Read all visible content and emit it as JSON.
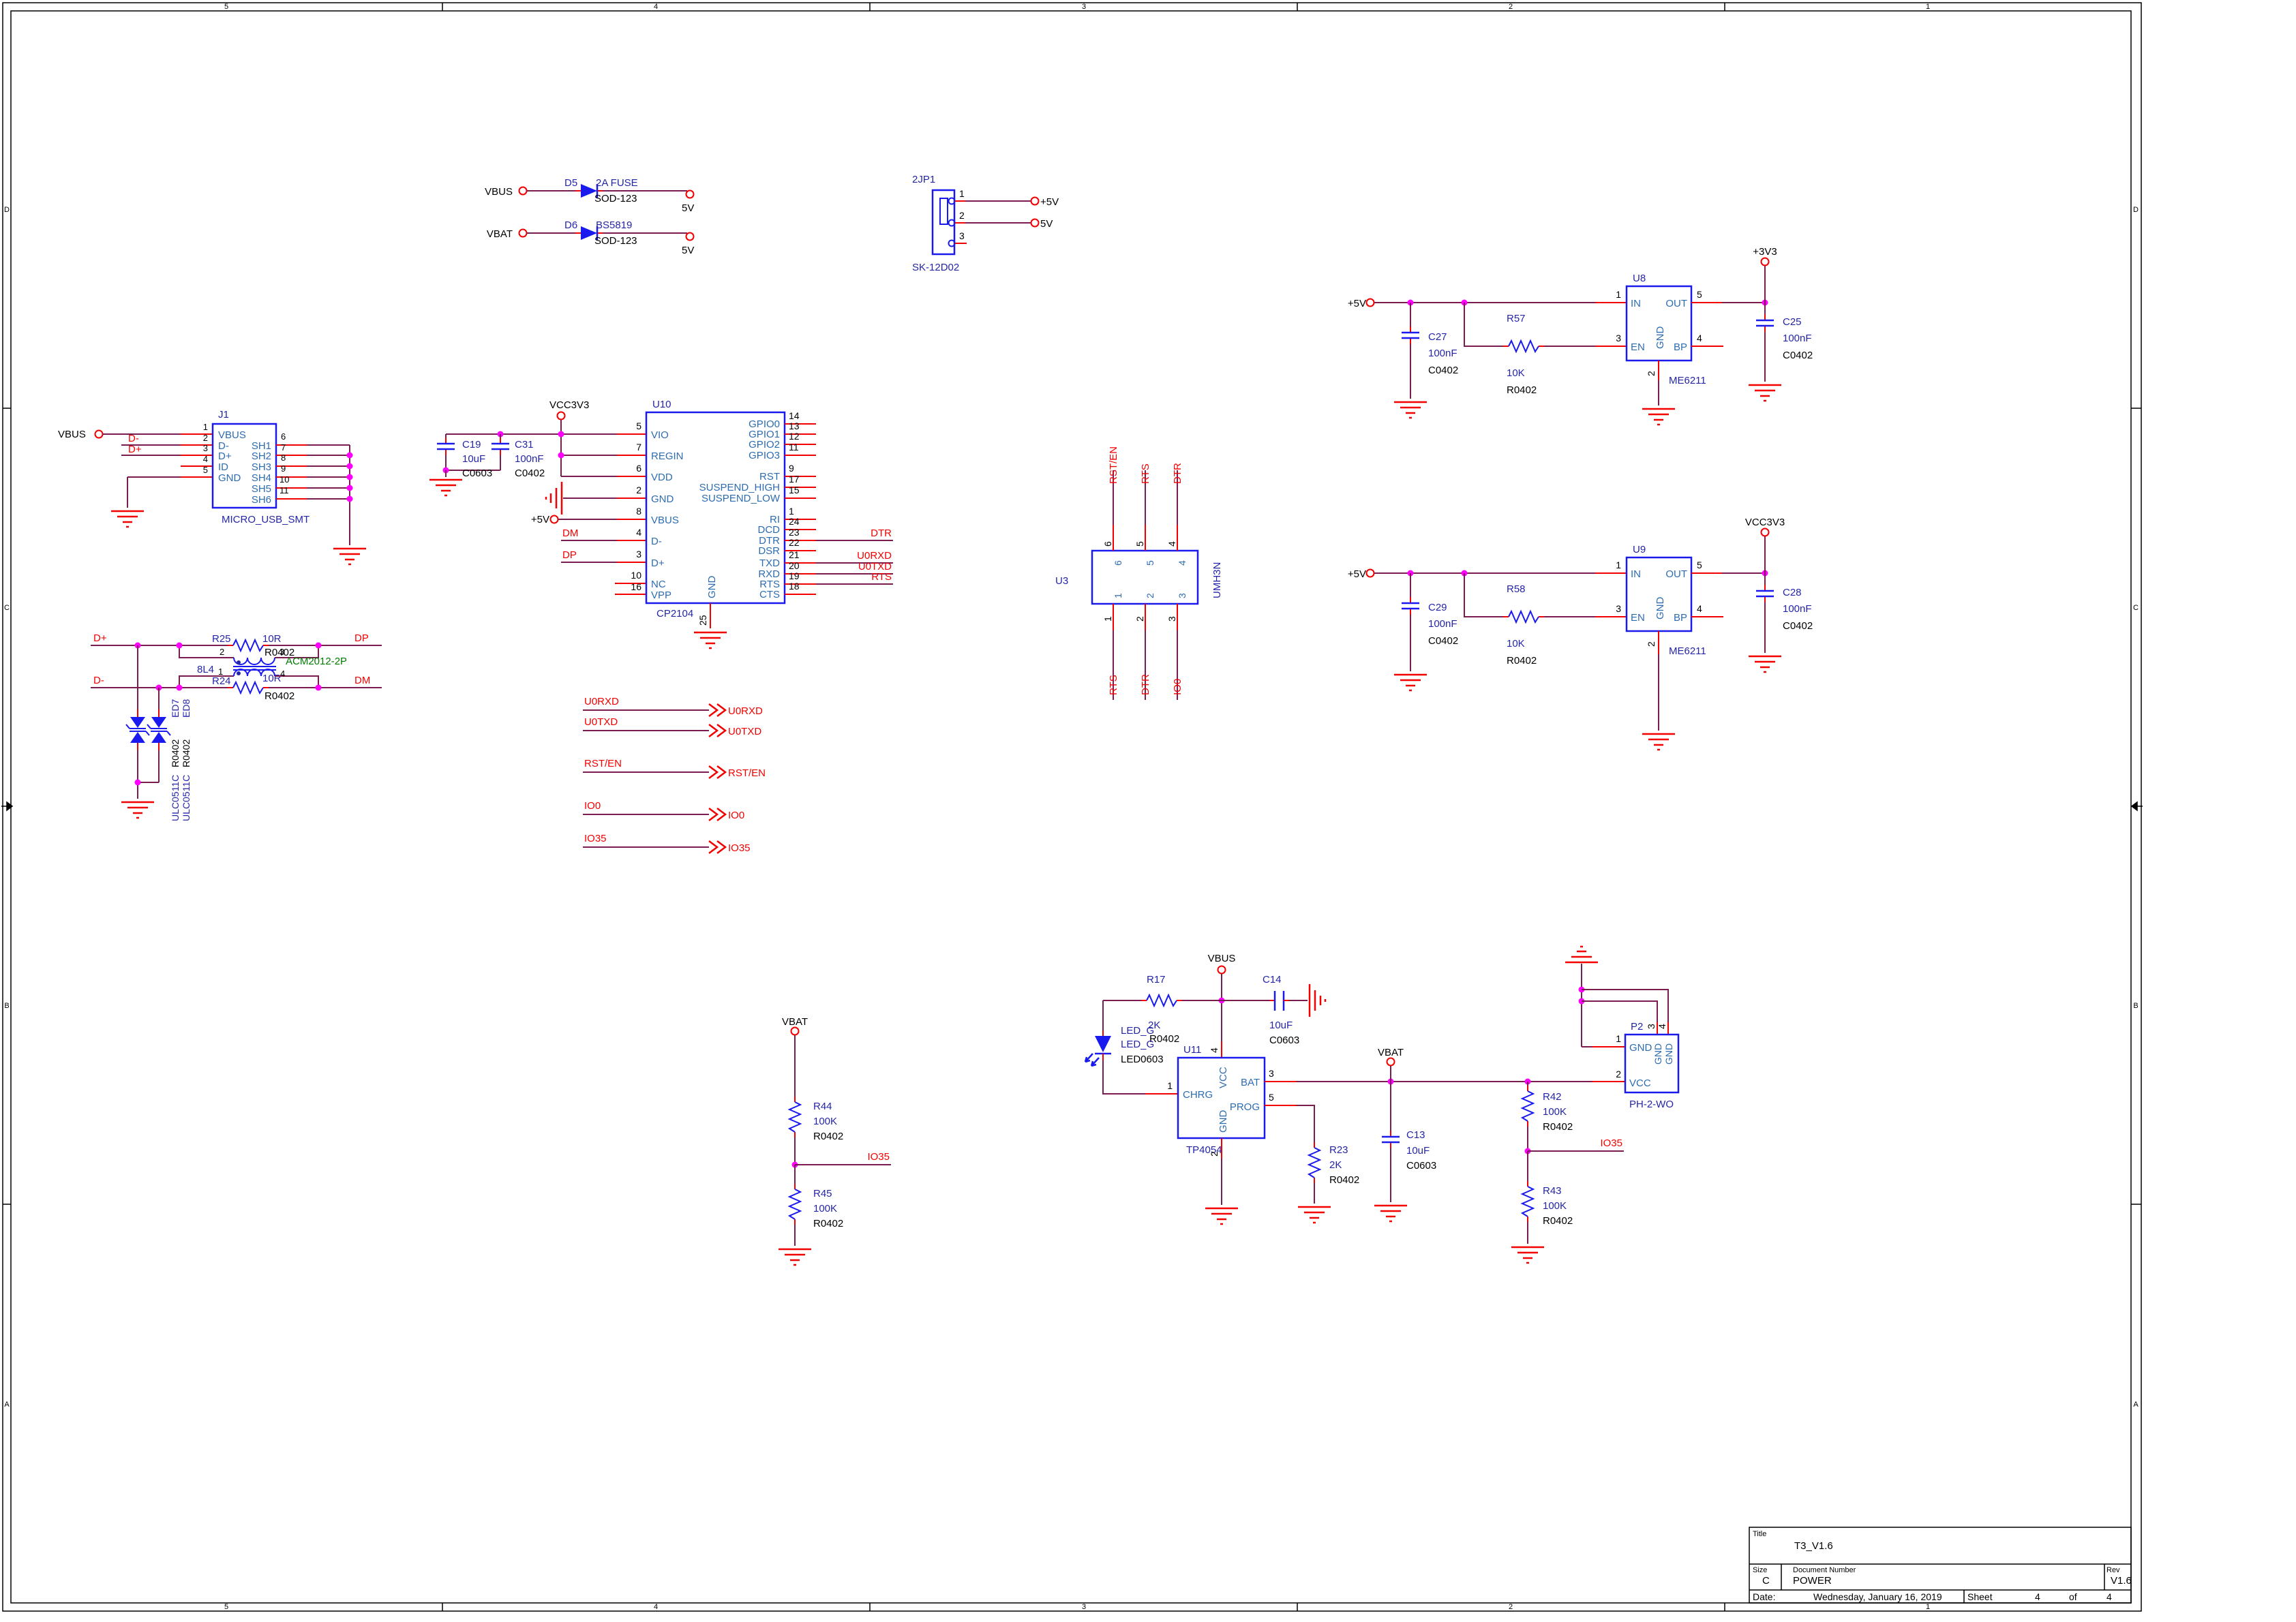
{
  "frame": {
    "zones_h": [
      "5",
      "4",
      "3",
      "2",
      "1"
    ],
    "zones_v": [
      "D",
      "C",
      "B",
      "A"
    ],
    "tb": {
      "title_label": "Title",
      "title": "T3_V1.6",
      "size_label": "Size",
      "size": "C",
      "doc_label": "Document Number",
      "doc": "POWER",
      "rev_label": "Rev",
      "rev": "V1.6",
      "date_label": "Date:",
      "date": "Wednesday, January 16, 2019",
      "sheet_label": "Sheet",
      "sheet_no": "4",
      "of": "of",
      "sheet_total": "4"
    }
  },
  "power_in": {
    "vbus_label": "VBUS",
    "vbat_label": "VBAT",
    "d5_ref": "D5",
    "d5_val": "2A FUSE",
    "d5_fp": "SOD-123",
    "d5_net": "5V",
    "d6_ref": "D6",
    "d6_val": "BS5819",
    "d6_fp": "SOD-123",
    "d6_net": "5V"
  },
  "jp1": {
    "ref": "2JP1",
    "fp": "SK-12D02",
    "p1": "1",
    "p2": "2",
    "p3": "3",
    "net1": "+5V",
    "net2": "5V"
  },
  "usb": {
    "ref": "J1",
    "fp": "MICRO_USB_SMT",
    "vbus": "VBUS",
    "pin_numbers": [
      "1",
      "2",
      "3",
      "4",
      "5",
      "6",
      "7",
      "8",
      "9",
      "10",
      "11"
    ],
    "left_names": [
      "VBUS",
      "D-",
      "D+",
      "ID",
      "GND"
    ],
    "right_names": [
      "SH1",
      "SH2",
      "SH3",
      "SH4",
      "SH5",
      "SH6"
    ],
    "dm_label": "D-",
    "dp_label": "D+"
  },
  "esd": {
    "dplus": "D+",
    "dminus": "D-",
    "dp": "DP",
    "dm": "DM",
    "r25_ref": "R25",
    "r25_val": "10R",
    "r25_fp": "R0402",
    "r24_ref": "R24",
    "r24_val": "10R",
    "r24_fp": "R0402",
    "choke_ref": "8L4",
    "choke_val": "ACM2012-2P",
    "choke_pins": [
      "1",
      "2",
      "3",
      "4"
    ],
    "ed7": "ED7",
    "ed8": "ED8",
    "ed_fp1": "R0402",
    "ed_fp2": "R0402",
    "ed_val1": "ULC0511C",
    "ed_val2": "ULC0511C"
  },
  "cp2104": {
    "ref": "U10",
    "val": "CP2104",
    "vcc": "VCC3V3",
    "p5v": "+5V",
    "c19_ref": "C19",
    "c19_val": "10uF",
    "c19_fp": "C0603",
    "c31_ref": "C31",
    "c31_val": "100nF",
    "c31_fp": "C0402",
    "dm": "DM",
    "dp": "DP",
    "left": [
      {
        "num": "5",
        "name": "VIO"
      },
      {
        "num": "7",
        "name": "REGIN"
      },
      {
        "num": "6",
        "name": "VDD"
      },
      {
        "num": "2",
        "name": "GND"
      },
      {
        "num": "8",
        "name": "VBUS"
      },
      {
        "num": "4",
        "name": "D-"
      },
      {
        "num": "3",
        "name": "D+"
      },
      {
        "num": "10",
        "name": "NC"
      },
      {
        "num": "16",
        "name": "VPP"
      }
    ],
    "right": [
      {
        "num": "14",
        "name": "GPIO0"
      },
      {
        "num": "13",
        "name": "GPIO1"
      },
      {
        "num": "12",
        "name": "GPIO2"
      },
      {
        "num": "11",
        "name": "GPIO3"
      },
      {
        "num": "9",
        "name": "RST"
      },
      {
        "num": "17",
        "name": "SUSPEND_HIGH"
      },
      {
        "num": "15",
        "name": "SUSPEND_LOW"
      },
      {
        "num": "1",
        "name": "RI"
      },
      {
        "num": "24",
        "name": "DCD"
      },
      {
        "num": "23",
        "name": "DTR"
      },
      {
        "num": "22",
        "name": "DSR"
      },
      {
        "num": "21",
        "name": "TXD"
      },
      {
        "num": "20",
        "name": "RXD"
      },
      {
        "num": "19",
        "name": "RTS"
      },
      {
        "num": "18",
        "name": "CTS"
      }
    ],
    "gnd_pin": {
      "num": "25",
      "name": "GND"
    },
    "net_dtr": "DTR",
    "net_u0rxd": "U0RXD",
    "net_u0txd": "U0TXD",
    "net_rts": "RTS"
  },
  "u3": {
    "ref": "U3",
    "val": "UMH3N",
    "top": [
      {
        "num": "6",
        "net": "RST/EN"
      },
      {
        "num": "5",
        "net": "RTS"
      },
      {
        "num": "4",
        "net": "DTR"
      }
    ],
    "bottom": [
      {
        "num": "1",
        "net": "RTS"
      },
      {
        "num": "2",
        "net": "DTR"
      },
      {
        "num": "3",
        "net": "IO0"
      }
    ]
  },
  "offpage": [
    {
      "net": "U0RXD"
    },
    {
      "net": "U0TXD"
    },
    {
      "net": "RST/EN"
    },
    {
      "net": "IO0"
    },
    {
      "net": "IO35"
    }
  ],
  "ldo1": {
    "in_net": "+5V",
    "ref": "U8",
    "val": "ME6211",
    "out_net": "+3V3",
    "c_in_ref": "C27",
    "c_in_val": "100nF",
    "c_in_fp": "C0402",
    "r_ref": "R57",
    "r_val": "10K",
    "r_fp": "R0402",
    "c_out_ref": "C25",
    "c_out_val": "100nF",
    "c_out_fp": "C0402",
    "pins": {
      "in": {
        "num": "1",
        "name": "IN"
      },
      "en": {
        "num": "3",
        "name": "EN"
      },
      "gnd": {
        "num": "2",
        "name": "GND"
      },
      "out": {
        "num": "5",
        "name": "OUT"
      },
      "bp": {
        "num": "4",
        "name": "BP"
      }
    }
  },
  "ldo2": {
    "in_net": "+5V",
    "ref": "U9",
    "val": "ME6211",
    "out_net": "VCC3V3",
    "c_in_ref": "C29",
    "c_in_val": "100nF",
    "c_in_fp": "C0402",
    "r_ref": "R58",
    "r_val": "10K",
    "r_fp": "R0402",
    "c_out_ref": "C28",
    "c_out_val": "100nF",
    "c_out_fp": "C0402",
    "pins": {
      "in": {
        "num": "1",
        "name": "IN"
      },
      "en": {
        "num": "3",
        "name": "EN"
      },
      "gnd": {
        "num": "2",
        "name": "GND"
      },
      "out": {
        "num": "5",
        "name": "OUT"
      },
      "bp": {
        "num": "4",
        "name": "BP"
      }
    }
  },
  "charger": {
    "vbus": "VBUS",
    "vbat": "VBAT",
    "r17_ref": "R17",
    "r17_val": "2K",
    "r17_fp": "R0402",
    "led_ref": "LED_G",
    "led_val": "LED_G",
    "led_fp": "LED0603",
    "c14_ref": "C14",
    "c14_val": "10uF",
    "c14_fp": "C0603",
    "u11_ref": "U11",
    "u11_val": "TP4054",
    "pins": {
      "chrg": {
        "num": "1",
        "name": "CHRG"
      },
      "vcc": {
        "num": "4",
        "name": "VCC"
      },
      "gnd": {
        "num": "2",
        "name": "GND"
      },
      "bat": {
        "num": "3",
        "name": "BAT"
      },
      "prog": {
        "num": "5",
        "name": "PROG"
      }
    },
    "r23_ref": "R23",
    "r23_val": "2K",
    "r23_fp": "R0402",
    "c13_ref": "C13",
    "c13_val": "10uF",
    "c13_fp": "C0603"
  },
  "p2": {
    "ref": "P2",
    "fp": "PH-2-WO",
    "p1": "1",
    "p2": "2",
    "p3": "3",
    "p4": "4",
    "gnd": "GND",
    "vcc": "VCC",
    "gnd3": "GND",
    "gnd4": "GND"
  },
  "div1": {
    "vbat": "VBAT",
    "r44_ref": "R44",
    "r44_val": "100K",
    "r44_fp": "R0402",
    "net": "IO35",
    "r45_ref": "R45",
    "r45_val": "100K",
    "r45_fp": "R0402"
  },
  "div2": {
    "r42_ref": "R42",
    "r42_val": "100K",
    "r42_fp": "R0402",
    "net": "IO35",
    "r43_ref": "R43",
    "r43_val": "100K",
    "r43_fp": "R0402"
  }
}
